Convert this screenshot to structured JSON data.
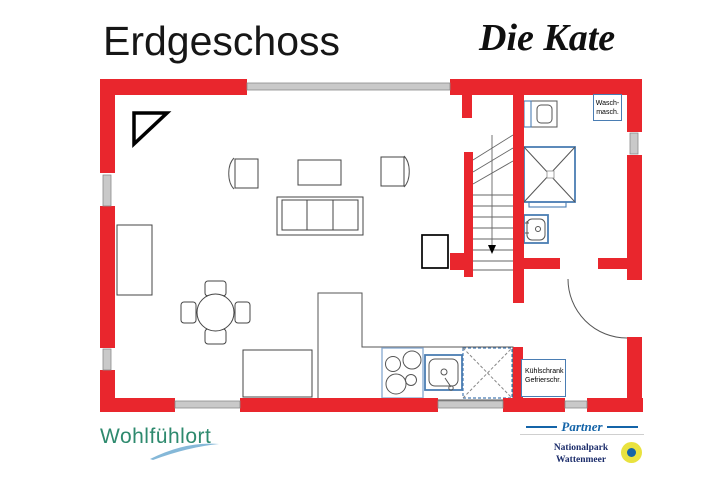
{
  "header": {
    "floor_title": "Erdgeschoss",
    "house_name": "Die Kate"
  },
  "plan": {
    "labels": {
      "washing_machine": {
        "line1": "Wasch-",
        "line2": "masch."
      },
      "fridge": {
        "line1": "Kühlschrank",
        "line2": "Gefrierschr."
      }
    },
    "symbols": [
      "north-triangle",
      "staircase-with-down-arrow",
      "sofa",
      "armchair-left",
      "armchair-right",
      "coffee-table",
      "dining-table-round",
      "dining-chairs",
      "dresser",
      "sideboard",
      "pantry-cabinet",
      "kitchen-counter",
      "stove",
      "kitchen-sink",
      "dishwasher",
      "shower",
      "toilet",
      "washbasin",
      "entrance-door-arc",
      "window-segments"
    ]
  },
  "footer": {
    "brand": "Wohlfühlort",
    "partner": {
      "label": "Partner",
      "org_line1": "Nationalpark",
      "org_line2": "Wattenmeer"
    }
  },
  "colors": {
    "wall_red": "#e9262d",
    "window_gray": "#c9c9c9",
    "fixture_blue": "#4a7db3",
    "brand_teal": "#2e8a6e",
    "partner_blue": "#1464a8",
    "org_navy": "#1c2d6b",
    "logo_yellow": "#e9e23f"
  }
}
